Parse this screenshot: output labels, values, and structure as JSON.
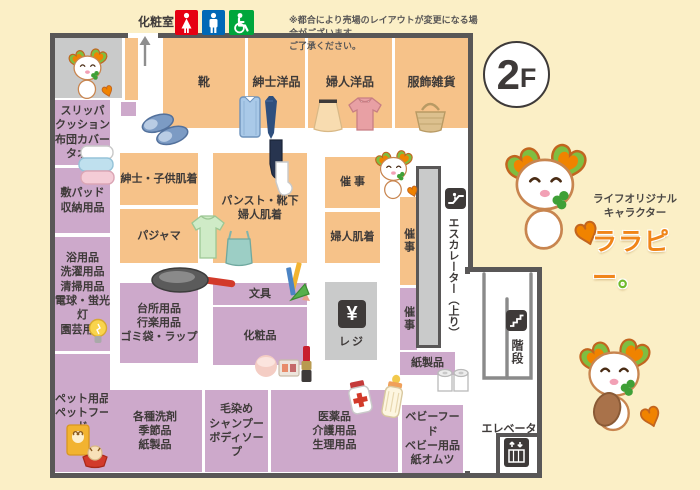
{
  "floor_badge": {
    "number": "2",
    "suffix": "F"
  },
  "notice": {
    "line1": "※都合により売場のレイアウトが変更になる場合がございます。",
    "line2": "ご了承ください。"
  },
  "restroom": {
    "label": "化粧室"
  },
  "departments": {
    "shoes": "靴",
    "mens_wear": "紳士洋品",
    "womens_wear": "婦人洋品",
    "fashion_goods": "服飾雑貨",
    "slippers_cushion": "スリッパ\nクッション\n布団カバー\nタオル",
    "bed_pads_storage": "敷パッド\n収納用品",
    "bath_laundry": "浴用品\n洗濯用品\n清掃用品\n電球・蛍光灯\n園芸用品",
    "pet": "ペット用品\nペットフード",
    "mens_kids_underwear": "紳士・子供肌着",
    "pajamas": "パジャマ",
    "pantyhose_socks": "パンスト・靴下\n婦人肌着",
    "event_main": "催 事",
    "womens_underwear": "婦人肌着",
    "event_side1": "催事",
    "event_side2": "催事",
    "kitchen_goods": "台所用品\n行楽用品\nゴミ袋・ラップ",
    "stationery": "文具",
    "cosmetics": "化粧品",
    "detergents": "各種洗剤\n季節品\n紙製品",
    "hair_care": "毛染め\nシャンプー\nボディソープ",
    "medicine_care": "医薬品\n介護用品\n生理用品",
    "baby": "ベビーフード\nベビー用品\n紙オムツ",
    "paper_products": "紙製品"
  },
  "facilities": {
    "register_label": "レジ",
    "register_symbol": "¥",
    "escalator_label": "エスカレーター（上り）",
    "stairs_label": "階段",
    "elevator_label": "エレベーター"
  },
  "character": {
    "caption_line1": "ライフオリジナル",
    "caption_line2": "キャラクター",
    "name": "ララピー",
    "name_period": "。"
  },
  "colors": {
    "background": "#FBEFC6",
    "wall": "#595757",
    "dept_orange": "#F6C289",
    "dept_purple": "#CDA9CB",
    "facility_gray": "#C9CACA",
    "accent_orange": "#F08300",
    "accent_green": "#7FBE41",
    "restroom_female": "#E60012",
    "restroom_male": "#0068B7",
    "restroom_accessible": "#00A63C"
  }
}
